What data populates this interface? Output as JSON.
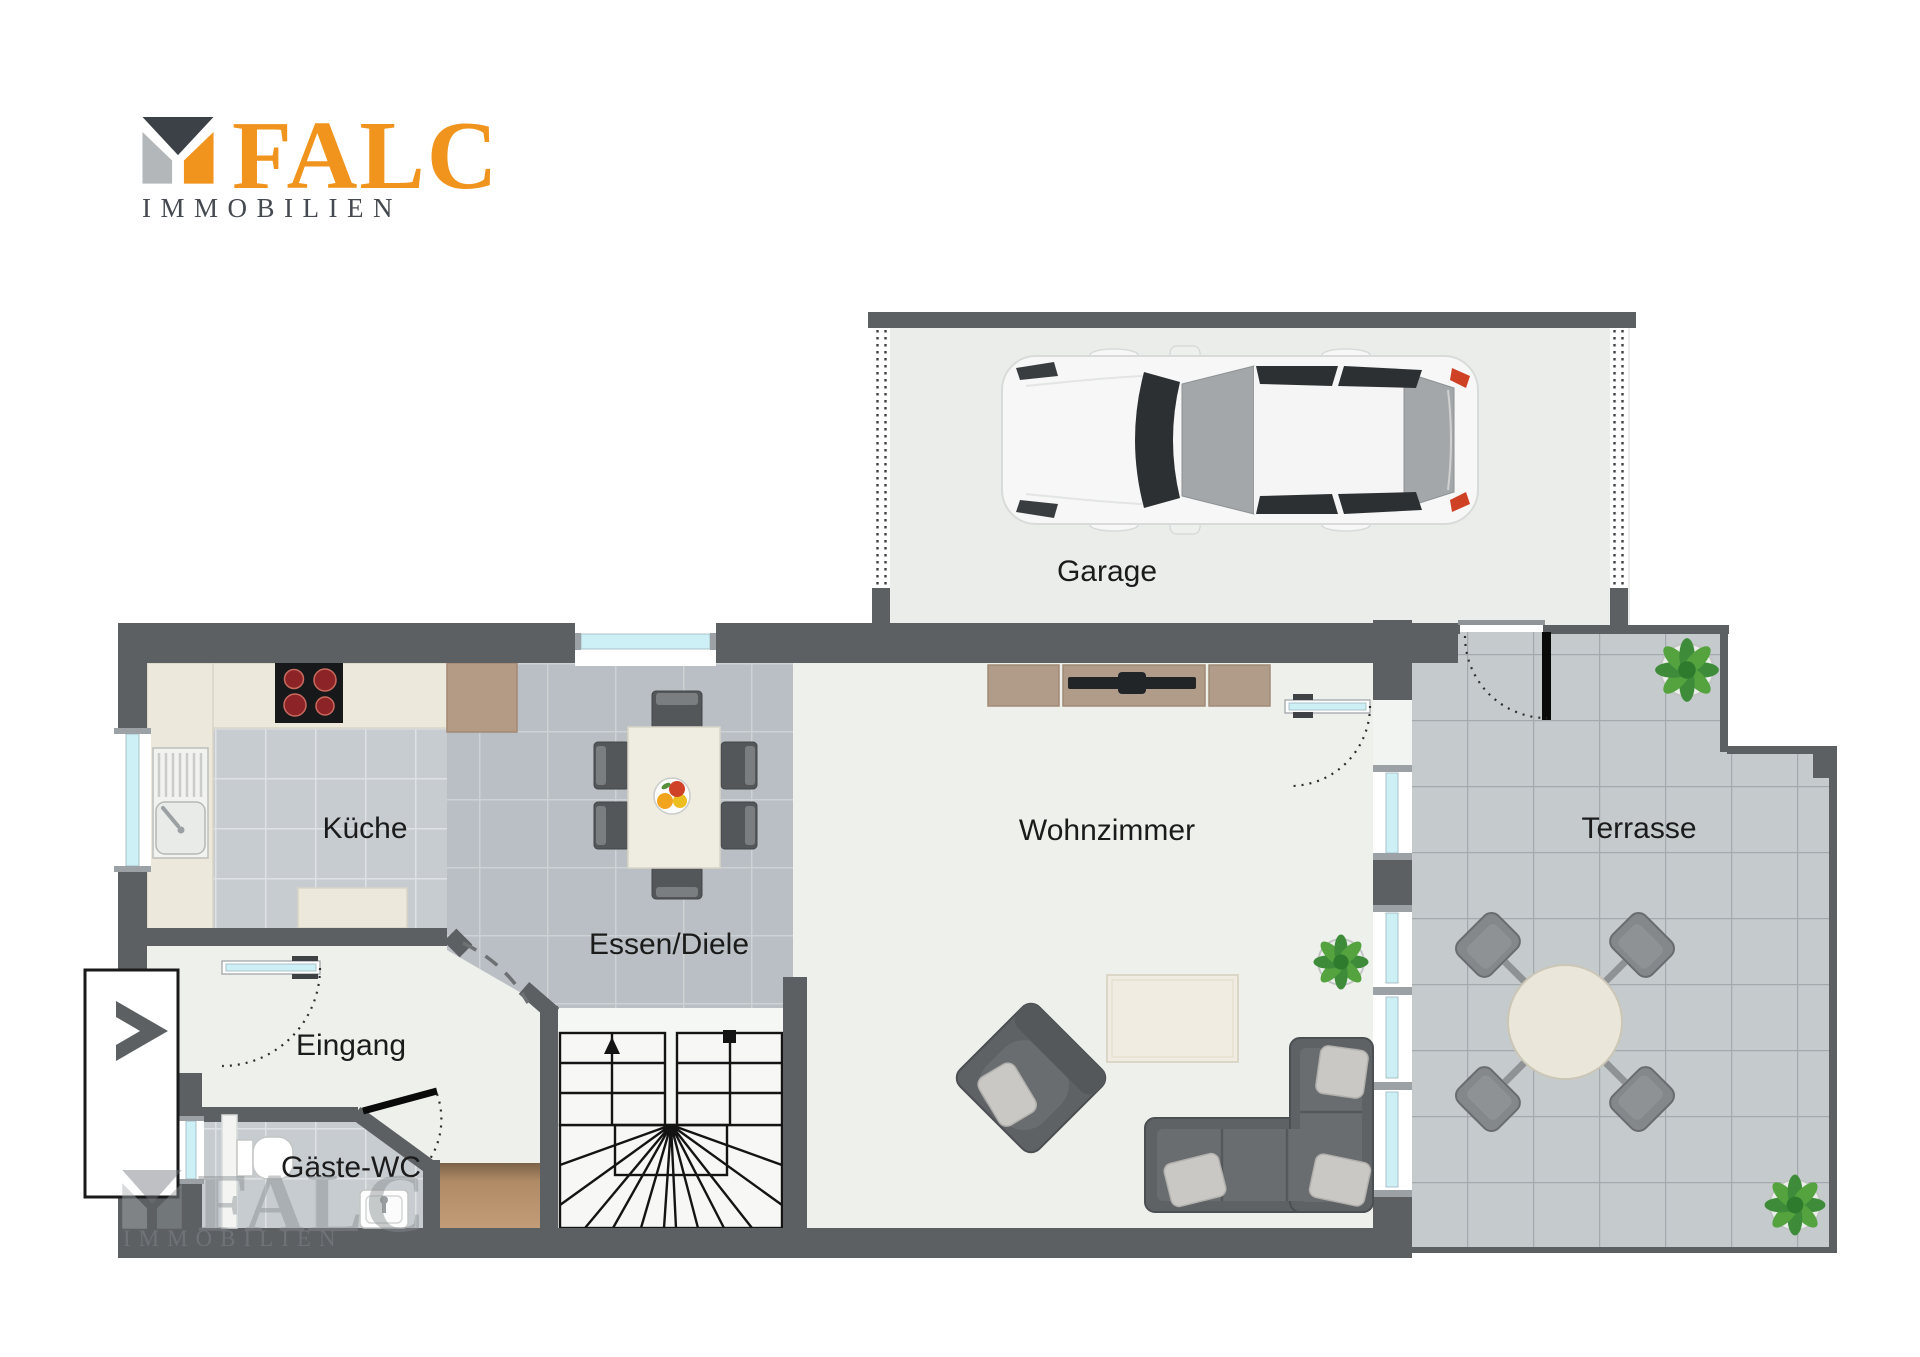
{
  "logo": {
    "brand": "FALC",
    "subtitle": "IMMOBILIEN"
  },
  "watermark": {
    "brand": "FALC",
    "subtitle": "IMMOBILIEN"
  },
  "rooms": {
    "garage": {
      "label": "Garage"
    },
    "kueche": {
      "label": "Küche"
    },
    "essen_diele": {
      "label": "Essen/Diele"
    },
    "wohnzimmer": {
      "label": "Wohnzimmer"
    },
    "terrasse": {
      "label": "Terrasse"
    },
    "eingang": {
      "label": "Eingang"
    },
    "gaeste_wc": {
      "label": "Gäste-WC"
    }
  },
  "colors": {
    "wall": "#5d6063",
    "glass": "#cdeff6",
    "floor_light": "#eef0ec",
    "tile_kitchen": "#c7ccd1",
    "tile_dining": "#b9bfc4",
    "tile_terrace": "#c5cacd",
    "counter": "#ece9dc",
    "wood": "#b49b85",
    "furniture": "#5f6265",
    "brand_orange": "#f0941d",
    "brand_dark": "#454a50",
    "label": "#1b1b1b"
  }
}
